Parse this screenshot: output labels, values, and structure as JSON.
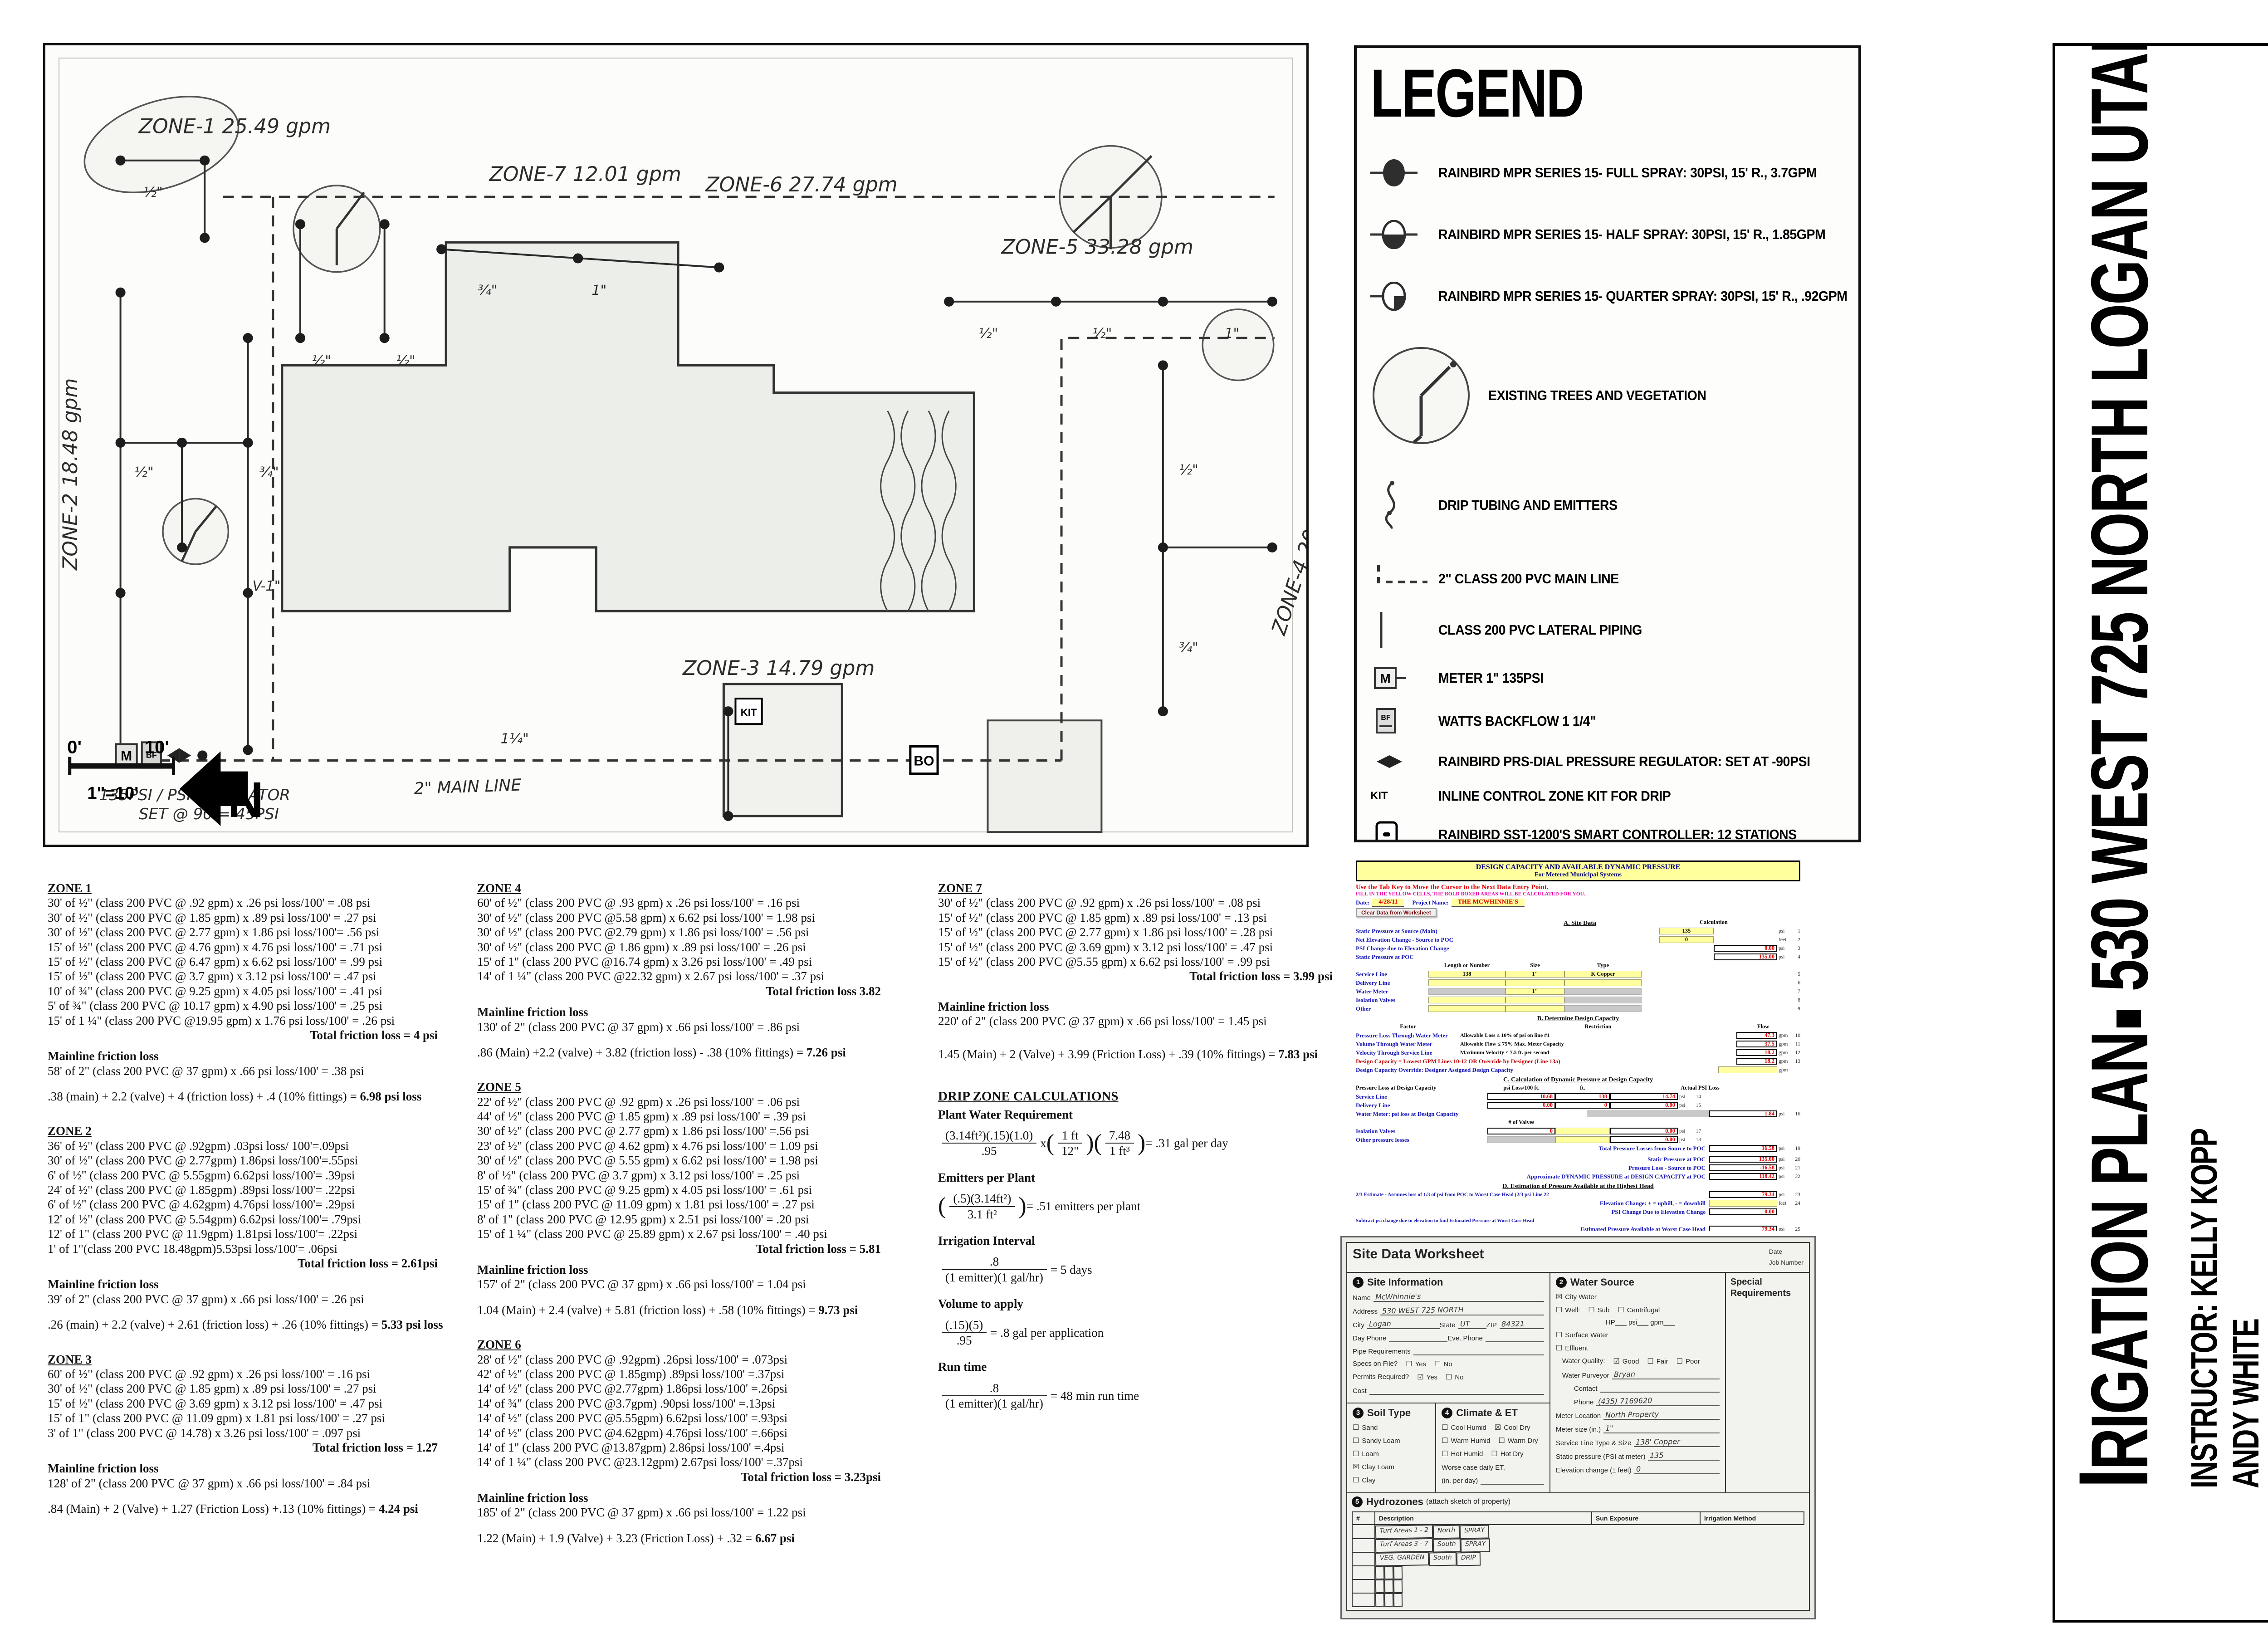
{
  "map": {
    "z1": "ZONE-1  25.49 gpm",
    "z2": "ZONE-2  18.48 gpm",
    "z3": "ZONE-3  14.79 gpm",
    "z4": "ZONE-4  20.30 gpm",
    "z5": "ZONE-5  33.28 gpm",
    "z6": "ZONE-6  27.74 gpm",
    "z7": "ZONE-7  12.01 gpm",
    "mainline_label": "2\" MAIN LINE",
    "reg1": "135PSI / PSI REGULATOR",
    "reg2": "SET @ 90 = 45PSI",
    "v1": "V-1\"",
    "m": "M",
    "bf": "BF",
    "bo": "BO",
    "kit": "KIT",
    "north": "N",
    "scale0": "0'",
    "scale10": "10'",
    "scale_ratio": "1\"=10'",
    "pipes": [
      "½\"",
      "½\"",
      "½\"",
      "¾\"",
      "1\"",
      "½\"",
      "½\"",
      "1\"",
      "½\"",
      "¾\"",
      "½\"",
      "¾\"",
      "1¼\""
    ]
  },
  "legend": {
    "title": "LEGEND",
    "items": [
      "RAINBIRD MPR SERIES 15- FULL SPRAY: 30PSI, 15' R., 3.7GPM",
      "RAINBIRD MPR SERIES 15- HALF SPRAY: 30PSI, 15' R., 1.85GPM",
      "RAINBIRD MPR SERIES 15- QUARTER SPRAY: 30PSI, 15' R., .92GPM",
      "EXISTING TREES AND VEGETATION",
      "DRIP TUBING AND EMITTERS",
      "2\" CLASS 200 PVC MAIN LINE",
      "CLASS 200 PVC LATERAL PIPING",
      "METER 1\" 135PSI",
      "WATTS BACKFLOW 1 1/4\"",
      "RAINBIRD PRS-DIAL PRESSURE REGULATOR: SET AT -90PSI",
      "INLINE CONTROL ZONE KIT FOR DRIP",
      "RAINBIRD SST-1200'S SMART CONTROLLER: 12 STATIONS",
      "BLOWOUT VALVE",
      "HUNTER ICV MODEL: 1\"-1 1/2\" VALVES"
    ],
    "icon_meter": "M",
    "icon_bf": "BF",
    "icon_kit": "KIT",
    "icon_bo": "BO"
  },
  "calc_labels": {
    "mainline": "Mainline friction loss"
  },
  "zones": [
    {
      "t": "ZONE 1",
      "lines": [
        "30' of ½\" (class 200 PVC @ .92 gpm) x .26 psi loss/100' = .08 psi",
        "30' of ½\" (class 200 PVC @ 1.85 gpm) x .89 psi loss/100' = .27 psi",
        "30' of ½\" (class 200 PVC @ 2.77 gpm) x 1.86 psi loss/100'= .56 psi",
        "15' of ½\" (class 200 PVC @ 4.76 gpm) x 4.76 psi loss/100' = .71 psi",
        "15' of ½\" (class 200 PVC @ 6.47 gpm) x 6.62 psi loss/100' = .99 psi",
        "15' of ½\" (class 200 PVC @ 3.7 gpm) x 3.12 psi loss/100' = .47 psi",
        "10' of ¾\" (class 200 PVC @ 9.25 gpm) x 4.05 psi loss/100' = .41 psi",
        "5' of ¾\" (class 200 PVC @ 10.17 gpm) x 4.90 psi loss/100' = .25 psi",
        "15' of 1 ¼\" (class 200 PVC @19.95 gpm) x 1.76 psi loss/100' = .26 psi"
      ],
      "total": "Total friction loss = 4 psi",
      "main": "58' of 2\" (class 200 PVC @ 37 gpm) x  .66 psi loss/100' = .38 psi",
      "sum": ".38 (main) + 2.2 (valve) + 4 (friction loss) + .4 (10% fittings) = ",
      "sumres": "6.98 psi loss"
    },
    {
      "t": "ZONE 2",
      "lines": [
        "36' of ½\" (class 200 PVC @ .92gpm) .03psi loss/ 100'=.09psi",
        "30' of ½\" (class 200 PVC @ 2.77gpm) 1.86psi loss/100'=.55psi",
        "6' of ½\" (class 200 PVC @ 5.55gpm) 6.62psi loss/100'= .39psi",
        "24' of ½\" (class 200 PVC @ 1.85gpm) .89psi loss/100'= .22psi",
        "6' of ½\" (class 200 PVC @ 4.62gpm) 4.76psi loss/100'= .29psi",
        "12' of ½\" (class 200 PVC @ 5.54gpm) 6.62psi loss/100'= .79psi",
        "12' of 1\" (class 200 PVC @ 11.9gpm) 1.81psi loss/100'= .22psi",
        "1' of 1\"(class 200 PVC 18.48gpm)5.53psi loss/100'= .06psi"
      ],
      "total": "Total friction loss = 2.61psi",
      "main": "39' of 2\" (class 200 PVC @ 37 gpm) x .66 psi loss/100' = .26 psi",
      "sum": ".26 (main) + 2.2 (valve) + 2.61 (friction loss) + .26 (10% fittings) = ",
      "sumres": "5.33 psi loss"
    },
    {
      "t": "ZONE 3",
      "lines": [
        "60' of ½\" (class 200 PVC @ .92 gpm) x .26 psi loss/100' = .16 psi",
        "30' of ½\" (class 200 PVC @ 1.85 gpm) x .89 psi loss/100' = .27 psi",
        "15' of ½\" (class 200 PVC @ 3.69 gpm) x 3.12 psi loss/100' = .47 psi",
        "15' of 1\" (class 200 PVC @ 11.09 gpm) x 1.81 psi loss/100' = .27 psi",
        "3' of 1\" (class 200 PVC @ 14.78) x 3.26 psi loss/100' = .097 psi"
      ],
      "total": "Total friction loss = 1.27",
      "main": "128' of 2\" (class 200 PVC @ 37 gpm) x .66 psi loss/100' = .84 psi",
      "sum": ".84 (Main) + 2 (Valve) + 1.27 (Friction Loss) +.13 (10% fittings) = ",
      "sumres": "4.24 psi"
    },
    {
      "t": "ZONE 4",
      "lines": [
        "60' of ½\" (class 200 PVC @ .93 gpm) x .26 psi loss/100' = .16 psi",
        "30' of ½\" (class 200 PVC @5.58 gpm) x 6.62 psi loss/100' = 1.98 psi",
        "30' of ½\" (class 200 PVC @2.79 gpm) x 1.86 psi loss/100' = .56 psi",
        "30' of ½\" (class 200 PVC @ 1.86 gpm) x .89 psi loss/100' = .26 psi",
        "15' of 1\" (class 200 PVC @16.74 gpm) x 3.26 psi loss/100' = .49 psi",
        "14' of 1 ¼\" (class 200 PVC @22.32 gpm) x 2.67 psi loss/100' = .37 psi"
      ],
      "total": "Total friction loss 3.82",
      "main": "130' of 2\" (class 200 PVC @ 37 gpm) x .66 psi loss/100' = .86 psi",
      "sum": ".86 (Main) +2.2 (valve) + 3.82 (friction loss) - .38 (10% fittings) = ",
      "sumres": "7.26 psi"
    },
    {
      "t": "ZONE 5",
      "lines": [
        "22' of ½\" (class 200 PVC @ .92 gpm) x .26 psi loss/100' = .06 psi",
        "44' of ½\" (class 200 PVC @ 1.85 gpm) x .89 psi loss/100' = .39 psi",
        "30' of ½\" (class 200 PVC @ 2.77 gpm) x 1.86 psi loss/100' =.56 psi",
        "23' of ½\" (class 200 PVC @ 4.62 gpm) x 4.76 psi loss/100' = 1.09 psi",
        "30' of ½\" (class 200 PVC @ 5.55 gpm) x 6.62 psi loss/100' = 1.98 psi",
        "8' of ½\" (class 200 PVC @ 3.7 gpm) x 3.12 psi loss/100' = .25 psi",
        "15' of ¾\" (class 200 PVC @ 9.25 gpm) x 4.05 psi loss/100' = .61 psi",
        "15' of 1\" (class 200 PVC @ 11.09 gpm) x 1.81 psi loss/100' = .27 psi",
        "8' of 1\" (class 200 PVC @ 12.95 gpm) x 2.51 psi loss/100' = .20 psi",
        "15' of 1 ¼\" (class 200 PVC @ 25.89 gpm) x 2.67 psi loss/100' = .40 psi"
      ],
      "total": "Total friction loss = 5.81",
      "main": "157' of 2\" (class 200 PVC @ 37 gpm) x .66 psi loss/100' = 1.04 psi",
      "sum": "1.04 (Main) + 2.4 (valve) + 5.81 (friction loss) + .58 (10% fittings) = ",
      "sumres": "9.73 psi"
    },
    {
      "t": "ZONE 6",
      "lines": [
        "28' of ½\" (class 200 PVC @ .92gpm) .26psi loss/100' = .073psi",
        "42' of ½\"  (class 200 PVC @ 1.85gmp) .89psi loss/100' =.37psi",
        "14' of ½\" (class 200 PVC @2.77gpm) 1.86psi loss/100' =.26psi",
        "14' of ¾\" (class 200 PVC @3.7gpm) .90psi loss/100' =.13psi",
        "14' of ½\" (class 200 PVC @5.55gpm) 6.62psi loss/100' =.93psi",
        "14' of ½\" (class 200 PVC @4.62gpm) 4.76psi loss/100' =.66psi",
        "14' of 1\" (class 200 PVC @13.87gpm) 2.86psi loss/100' =.4psi",
        "14' of 1 ¼\" (class 200 PVC @23.12gpm) 2.67psi loss/100' =.37psi"
      ],
      "total": "Total friction loss = 3.23psi",
      "main": "185' of 2\" (class 200 PVC @ 37 gpm) x .66 psi loss/100' = 1.22 psi",
      "sum": "1.22 (Main) + 1.9 (Valve) + 3.23 (Friction Loss) + .32 = ",
      "sumres": "6.67 psi"
    },
    {
      "t": "ZONE 7",
      "lines": [
        "30' of ½\" (class 200 PVC @ .92 gpm) x .26 psi loss/100' = .08 psi",
        "15' of ½\" (class 200 PVC @ 1.85 gpm) x .89 psi loss/100' = .13 psi",
        "15' of ½\" (class 200 PVC @ 2.77 gpm) x 1.86 psi loss/100' = .28 psi",
        "15' of ½\" (class 200 PVC @ 3.69 gpm) x 3.12 psi loss/100' = .47 psi",
        "15' of ½\" (class 200 PVC @5.55 gpm) x 6.62 psi loss/100' = .99 psi"
      ],
      "total": "Total friction loss = 3.99 psi",
      "main": "220' of 2\" (class 200 PVC @ 37 gpm) x .66 psi loss/100' = 1.45 psi",
      "sum": "1.45 (Main) + 2 (Valve) + 3.99 (Friction Loss) + .39 (10% fittings) = ",
      "sumres": "7.83 psi"
    }
  ],
  "drip": {
    "heading": "DRIP ZONE CALCULATIONS",
    "pwr_h": "Plant Water Requirement",
    "pwr_num": "(3.14ft²)(.15)(1.0)",
    "pwr_den": ".95",
    "pwr_x": "x",
    "f1_num": "1 ft",
    "f1_den": "12\"",
    "f2_num": "7.48",
    "f2_den": "1 ft³",
    "pwr_res": "= .31 gal per day",
    "epp_h": "Emitters per Plant",
    "epp_num": "(.5)(3.14ft²)",
    "epp_den": "3.1 ft²",
    "epp_res": "= .51 emitters per plant",
    "ii_h": "Irrigation Interval",
    "ii_num": ".8",
    "ii_den": "(1 emitter)(1 gal/hr)",
    "ii_res": "= 5 days",
    "vta_h": "Volume to apply",
    "vta_num": "(.15)(5)",
    "vta_den": ".95",
    "vta_res": "= .8 gal per application",
    "rt_h": "Run time",
    "rt_num": ".8",
    "rt_den": "(1 emitter)(1 gal/hr)",
    "rt_res": "= 48 min run time"
  },
  "sheet": {
    "title1": "DESIGN CAPACITY AND AVAILABLE DYNAMIC PRESSURE",
    "title2": "For Metered Municipal Systems",
    "instr1": "Use the Tab Key to Move the Cursor to the Next Data Entry Point.",
    "instr2": "FILL IN THE YELLOW CELLS, THE BOLD BOXED AREAS WILL BE CALCULATED FOR YOU.",
    "date_label": "Date:",
    "date": "4/28/11",
    "project_label": "Project Name:",
    "project": "THE MCWHINNIE'S",
    "clear_btn": "Clear Data from Worksheet",
    "secA": "A. Site Data",
    "calc": "Calculation",
    "a1": {
      "l": "Static Pressure at Source (Main)",
      "v": "135",
      "u": "psi",
      "n": "1"
    },
    "a2": {
      "l": "Net Elevation Change - Source to POC",
      "v": "0",
      "u": "feet",
      "n": "2"
    },
    "a3": {
      "l": "PSI Change due to Elevation Change",
      "v": "0.00",
      "u": "psi",
      "n": "3"
    },
    "a4": {
      "l": "Static Pressure at POC",
      "v": "135.00",
      "u": "psi",
      "n": "4"
    },
    "hL": "Length or Number",
    "hS": "Size",
    "hT": "Type",
    "a5": {
      "l": "Service Line",
      "c1": "138",
      "c2": "1\"",
      "c3": "K Copper",
      "n": "5"
    },
    "a6": {
      "l": "Delivery Line",
      "c1": "",
      "c2": "",
      "c3": "",
      "n": "6"
    },
    "a7": {
      "l": "Water Meter",
      "c2": "1\"",
      "n": "7"
    },
    "a8": {
      "l": "Isolation Valves",
      "n": "8"
    },
    "a9": {
      "l": "Other",
      "n": "9"
    },
    "secB": "B. Determine Design Capacity",
    "hFactor": "Factor",
    "hRestriction": "Restriction",
    "hFlow": "Flow",
    "b10": {
      "l": "Pressure Loss Through Water Meter",
      "r": "Allowable Loss ≤ 10% of psi on line #1",
      "v": "47.3",
      "u": "gpm",
      "n": "10"
    },
    "b11": {
      "l": "Volume Through Water Meter",
      "r": "Allowable Flow ≤ 75% Max. Meter Capacity",
      "v": "37.5",
      "u": "gpm",
      "n": "11"
    },
    "b12": {
      "l": "Velocity Through Service Line",
      "r": "Maximum Velocity ≤ 7.5 ft. per second",
      "v": "18.2",
      "u": "gpm",
      "n": "12"
    },
    "b13": {
      "l": "Design Capacity = Lowest GPM Lines 10-12 OR Override by Designer (Line 13a)",
      "v": "18.2",
      "u": "gpm",
      "n": "13"
    },
    "b13a": {
      "l": "Design Capacity Override: Designer Assigned Design Capacity",
      "u": "gpm"
    },
    "secC": "C. Calculation of Dynamic Pressure at Design Capacity",
    "hPL": "Pressure Loss at Design Capacity",
    "hPsi100": "psi Loss/100 ft.",
    "hFt": "ft.",
    "hActual": "Actual PSI Loss",
    "c14": {
      "l": "Service Line",
      "v1": "10.68",
      "v2": "138",
      "v3": "14.74",
      "u": "psi",
      "n": "14"
    },
    "c15": {
      "l": "Delivery Line",
      "v1": "0.00",
      "v2": "0",
      "v3": "0.00",
      "u": "psi",
      "n": "15"
    },
    "c16": {
      "l": "Water Meter: psi loss at Design Capacity",
      "v3": "1.84",
      "u": "psi",
      "n": "16"
    },
    "hValves": "# of Valves",
    "c17": {
      "l": "Isolation Valves",
      "v1": "0",
      "v3": "0.00",
      "u": "psi",
      "n": "17"
    },
    "c18": {
      "l": "Other pressure losses",
      "v3": "0.00",
      "u": "psi",
      "n": "18"
    },
    "c19": {
      "l": "Total Pressure Losses from Source to POC",
      "v3": "16.58",
      "u": "psi",
      "n": "19"
    },
    "c20": {
      "l": "Static Pressure at POC",
      "v3": "135.00",
      "u": "psi",
      "n": "20"
    },
    "c21": {
      "l": "Pressure Loss - Source to POC",
      "v3": "-16.58",
      "u": "psi",
      "n": "21"
    },
    "c22": {
      "l": "Approximate DYNAMIC PRESSURE at DESIGN CAPACITY at POC",
      "v3": "118.42",
      "u": "psi",
      "n": "22"
    },
    "secD": "D. Estimation of Pressure Available at the Highest Head",
    "d23": {
      "l": "2/3 Estimate - Assumes loss of 1/3 of psi from POC to Worst Case Head (2/3 psi Line 22",
      "v3": "79.34",
      "u": "psi",
      "n": "23"
    },
    "d24": {
      "l": "Elevation Change:  + = uphill, - = downhill",
      "u": "feet",
      "n": "24"
    },
    "d24b": {
      "l": "PSI Change Due to Elevation Change",
      "v3": "0.00"
    },
    "dnote": "Subtract psi change due to elevation to find Estimated Pressure at Worst Case Head",
    "d25": {
      "l": "Estimated Pressure Available at Worst Case Head",
      "v3": "79.34",
      "u": "psi",
      "n": "25"
    },
    "cap_label": "SYSTEM DESIGN CAPACITY",
    "cap_value": "18.2 gpm",
    "avail_label": "AVAILABLE DYNAMIC PRESSURE AT WORST CASE HEAD",
    "avail_value": "79.34 psi"
  },
  "worksheet": {
    "title": "Site Data Worksheet",
    "date_label": "Date",
    "job_label": "Job Number",
    "s1": {
      "num": "1",
      "title": "Site Information",
      "name_l": "Name",
      "name_v": "McWhinnie's",
      "addr_l": "Address",
      "addr_v": "530 WEST 725 NORTH",
      "city_l": "City",
      "city_v": "Logan",
      "state_l": "State",
      "state_v": "UT",
      "zip_l": "ZIP",
      "zip_v": "84321",
      "day_l": "Day Phone",
      "eve_l": "Eve. Phone",
      "pipe_l": "Pipe Requirements",
      "specs_l": "Specs on File?",
      "specs_y": "☐",
      "specs_yl": "Yes",
      "specs_n": "☐",
      "specs_nl": "No",
      "perm_l": "Permits Required?",
      "perm_y": "☑",
      "perm_yl": "Yes",
      "perm_n": "☐",
      "perm_nl": "No",
      "cost_l": "Cost"
    },
    "s2": {
      "num": "2",
      "title": "Water Source",
      "city_g": "☒",
      "city_t": "City Water",
      "well_g": "☐",
      "well_t": "Well:",
      "sub_g": "☐",
      "sub_t": "Sub",
      "cent_g": "☐",
      "cent_t": "Centrifugal",
      "hp_line": "HP___  psi___ gpm___",
      "surf_g": "☐",
      "surf_t": "Surface Water",
      "eff_g": "☐",
      "eff_t": "Effluent",
      "qual_l": "Water Quality:",
      "good_g": "☑",
      "good_t": "Good",
      "fair_g": "☐",
      "fair_t": "Fair",
      "poor_g": "☐",
      "poor_t": "Poor",
      "purv_l": "Water Purveyor",
      "purv_v": "Bryan",
      "contact_l": "Contact",
      "phone_l": "Phone",
      "phone_v": "(435) 7169620",
      "mloc_l": "Meter Location",
      "mloc_v": "North Property",
      "msize_l": "Meter size (in.)",
      "msize_v": "1\"",
      "sline_l": "Service Line Type & Size",
      "sline_v": "138' Copper",
      "static_l": "Static pressure (PSI at meter)",
      "static_v": "135",
      "elev_l": "Elevation change (± feet)",
      "elev_v": "0"
    },
    "special1": "Special",
    "special2": "Requirements",
    "s3": {
      "num": "3",
      "title": "Soil Type",
      "items": [
        {
          "g": "☐",
          "t": "Sand"
        },
        {
          "g": "☐",
          "t": "Sandy Loam"
        },
        {
          "g": "☐",
          "t": "Loam"
        },
        {
          "g": "☒",
          "t": "Clay Loam"
        },
        {
          "g": "☐",
          "t": "Clay"
        }
      ]
    },
    "s4": {
      "num": "4",
      "title": "Climate & ET",
      "items": [
        {
          "g": "☐",
          "t": "Cool Humid"
        },
        {
          "g": "☒",
          "t": "Cool Dry"
        },
        {
          "g": "☐",
          "t": "Warm Humid"
        },
        {
          "g": "☐",
          "t": "Warm Dry"
        },
        {
          "g": "☐",
          "t": "Hot Humid"
        },
        {
          "g": "☐",
          "t": "Hot Dry"
        }
      ],
      "et1": "Worse case daily ET,",
      "et2": "(in. per day)"
    },
    "s5": {
      "num": "5",
      "title": "Hydrozones",
      "subtitle": "(attach sketch of property)",
      "headers": [
        "#",
        "Description",
        "Sun Exposure",
        "Irrigation Method"
      ],
      "rows": [
        [
          "",
          "Turf Areas  1 - 2",
          "North",
          "SPRAY"
        ],
        [
          "",
          "Turf Areas  3 - 7",
          "South",
          "SPRAY"
        ],
        [
          "",
          "VEG. GARDEN",
          "South",
          "DRIP"
        ],
        [
          "",
          "",
          "",
          ""
        ],
        [
          "",
          "",
          "",
          ""
        ],
        [
          "",
          "",
          "",
          ""
        ]
      ]
    }
  },
  "titleblock": {
    "initial": "I",
    "title_rest": "RIGATION PLAN",
    "address": "530 WEST 725 NORTH LOGAN UTAH",
    "instructor": "INSTRUCTOR: KELLY KOPP",
    "name2": "ANDY WHITE",
    "name3": "JD. MCWHINNIE",
    "university": "UTAH STATE UNIVERSITY"
  }
}
